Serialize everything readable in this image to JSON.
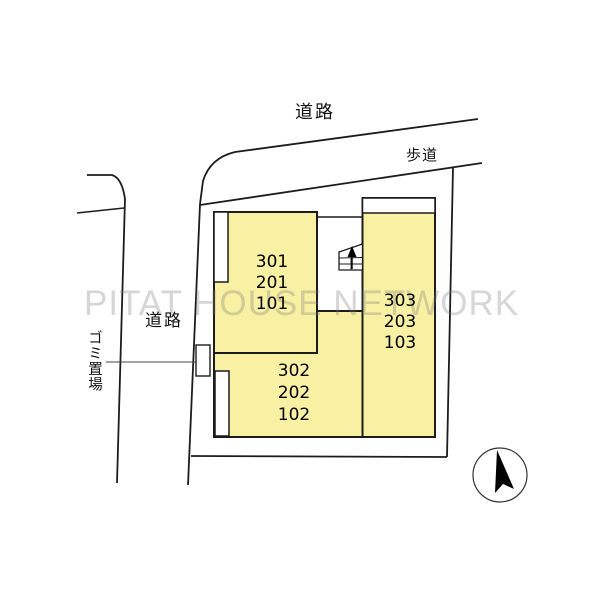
{
  "watermark": "PITAT HOUSE NETWORK",
  "labels": {
    "road_top": "道路",
    "sidewalk": "歩道",
    "road_left": "道路",
    "garbage_area": "ゴミ置場"
  },
  "buildings": {
    "block_a": {
      "units": [
        "301",
        "201",
        "101"
      ]
    },
    "block_b": {
      "units": [
        "302",
        "202",
        "102"
      ]
    },
    "block_c": {
      "units": [
        "303",
        "203",
        "103"
      ]
    }
  },
  "icons": {
    "compass": "north-compass-icon",
    "stairs": "staircase-up-icon"
  },
  "colors": {
    "building_fill": "#F8F0A2",
    "line": "#1C1C1C",
    "watermark_gray": "#BFBFBF",
    "background": "#FFFFFF"
  }
}
